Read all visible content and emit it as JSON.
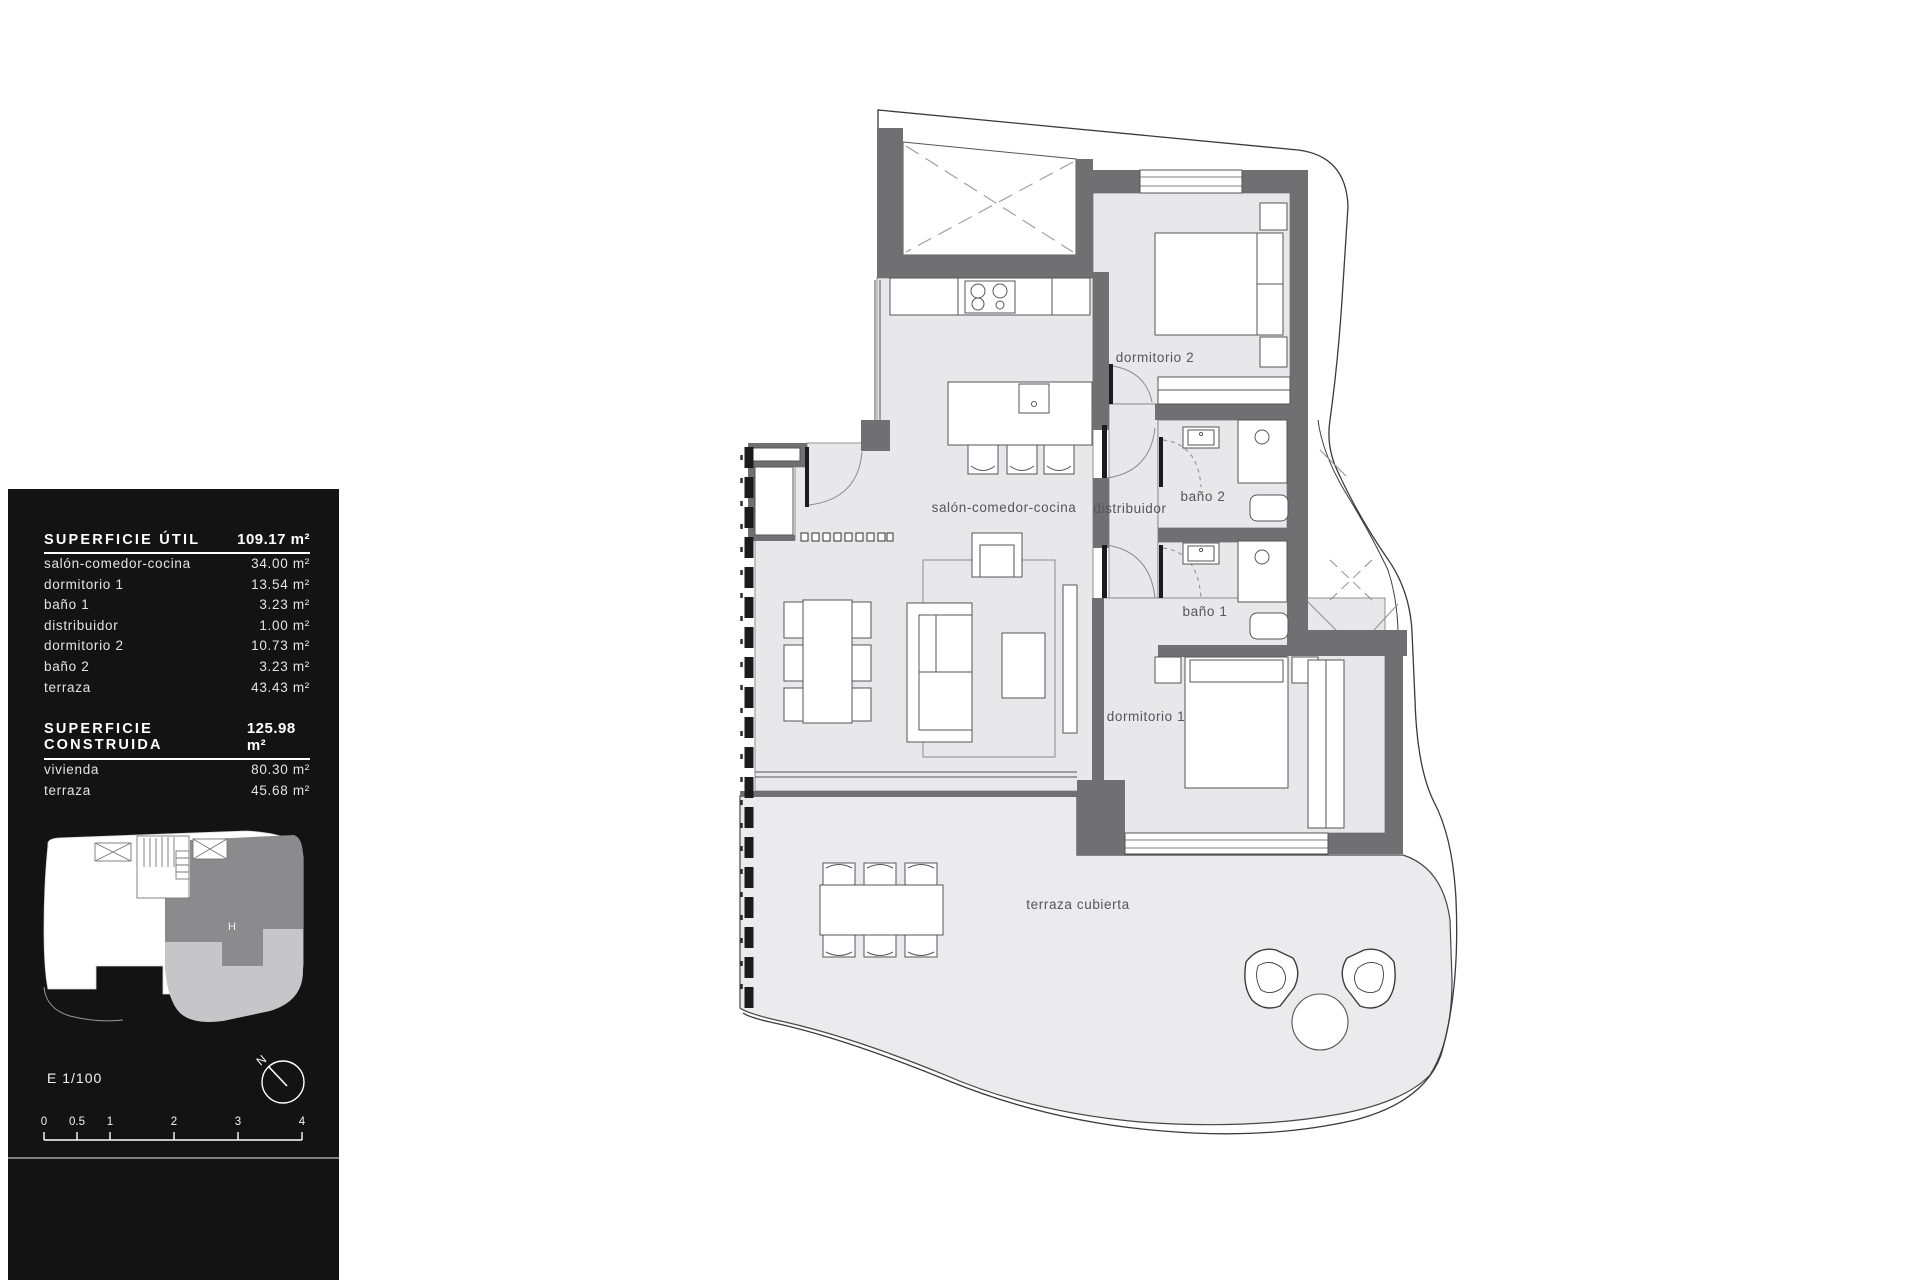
{
  "panel": {
    "useful": {
      "title": "SUPERFICIE ÚTIL",
      "total": "109.17 m²",
      "rows": [
        {
          "label": "salón-comedor-cocina",
          "value": "34.00 m²"
        },
        {
          "label": "dormitorio 1",
          "value": "13.54 m²"
        },
        {
          "label": "baño 1",
          "value": "3.23 m²"
        },
        {
          "label": "distribuidor",
          "value": "1.00 m²"
        },
        {
          "label": "dormitorio 2",
          "value": "10.73 m²"
        },
        {
          "label": "baño 2",
          "value": "3.23 m²"
        },
        {
          "label": "terraza",
          "value": "43.43 m²"
        }
      ]
    },
    "built": {
      "title": "SUPERFICIE CONSTRUIDA",
      "total": "125.98 m²",
      "rows": [
        {
          "label": "vivienda",
          "value": "80.30 m²"
        },
        {
          "label": "terraza",
          "value": "45.68 m²"
        }
      ]
    },
    "scale_label": "E 1/100",
    "north_label": "N",
    "unit_letter": "H",
    "scale_ticks": [
      "0",
      "0.5",
      "1",
      "2",
      "3",
      "4"
    ]
  },
  "plan": {
    "rooms": [
      {
        "id": "salon",
        "label": "salón-comedor-cocina"
      },
      {
        "id": "distribuidor",
        "label": "distribuidor"
      },
      {
        "id": "bano2",
        "label": "baño 2"
      },
      {
        "id": "bano1",
        "label": "baño 1"
      },
      {
        "id": "dorm2",
        "label": "dormitorio 2"
      },
      {
        "id": "dorm1",
        "label": "dormitorio 1"
      },
      {
        "id": "terraza",
        "label": "terraza cubierta"
      }
    ]
  },
  "colors": {
    "panel_bg": "#131313",
    "wall": "#707072",
    "floor": "#e8e8ea",
    "terrace_floor": "#ebebed",
    "outline": "#3a3a3d",
    "mini_unit": "#8b8b8e",
    "mini_terrace": "#c6c6c9"
  }
}
